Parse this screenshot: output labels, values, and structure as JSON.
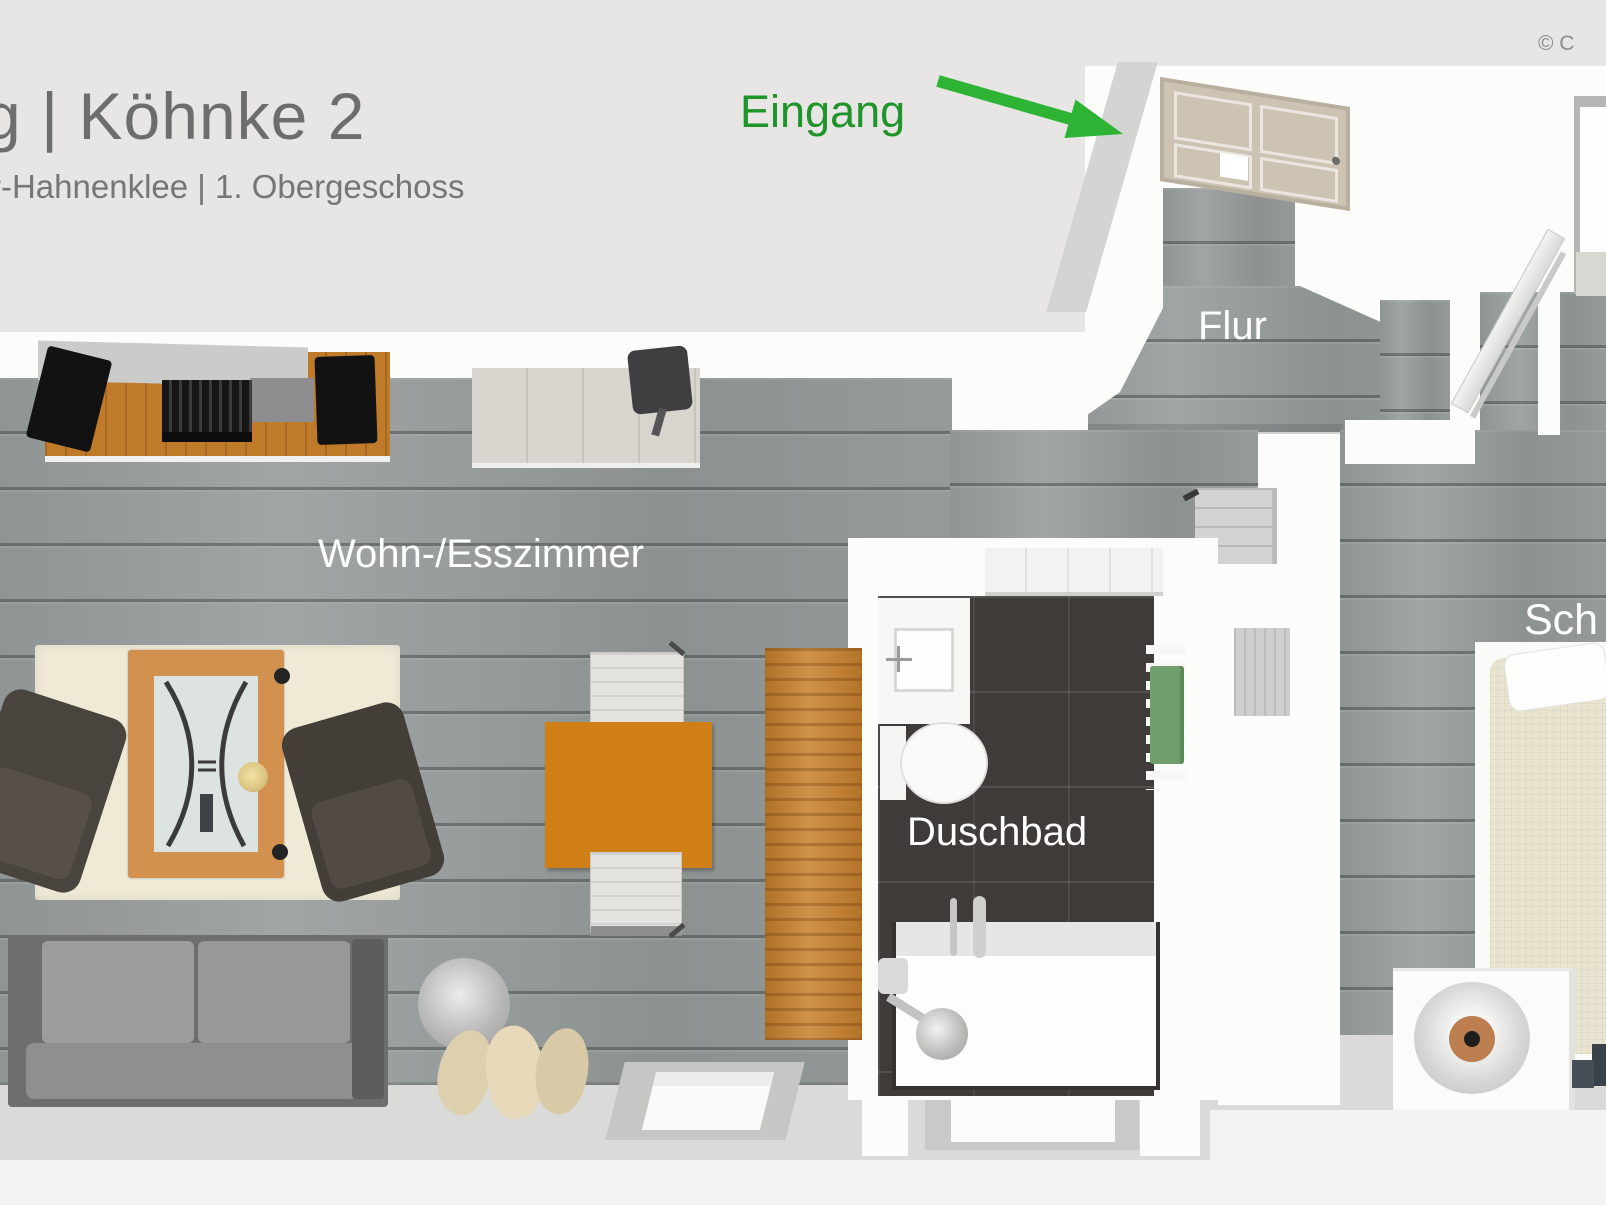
{
  "meta": {
    "kind": "3d-floor-plan-top-view"
  },
  "header": {
    "title_fragment": "g | Köhnke 2",
    "subtitle_fragment": "r-Hahnenklee | 1. Obergeschoss",
    "copyright_fragment": "© C"
  },
  "annotations": {
    "entrance": {
      "label": "Eingang",
      "text_color": "#1f9428",
      "arrow_color": "#2eb335"
    }
  },
  "rooms": [
    {
      "id": "flur",
      "label": "Flur"
    },
    {
      "id": "wohn-esszimmer",
      "label": "Wohn-/Esszimmer"
    },
    {
      "id": "duschbad",
      "label": "Duschbad"
    },
    {
      "id": "schlafzimmer",
      "label_fragment": "Sch"
    }
  ],
  "palette": {
    "background": "#e7e6e5",
    "wall_white": "#fcfcfb",
    "floor_wood_gray": "#9aa09f",
    "bath_tile_dark": "#3f3b39",
    "furniture_wood_orange": "#c8812c",
    "dining_table_orange": "#d07e16",
    "rug_cream": "#efe9d6",
    "sofa_gray": "#8f8f91",
    "towel_green": "#6f9f6d",
    "lamp_copper": "#bd7f4f",
    "room_label_white": "#ffffff",
    "title_gray": "#6d6d6d"
  }
}
